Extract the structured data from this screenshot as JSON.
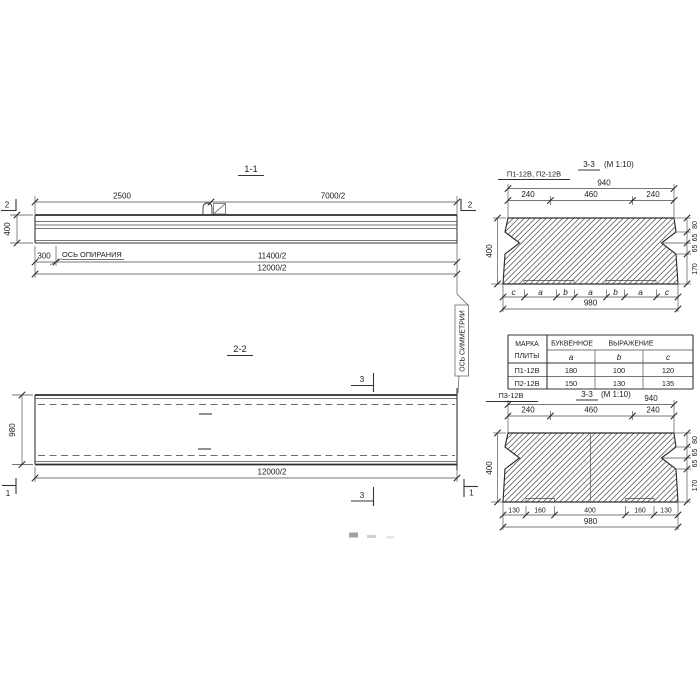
{
  "s11": {
    "title": "1-1",
    "cut_mark": "2",
    "dim_2500": "2500",
    "dim_7000": "7000/2",
    "dim_400": "400",
    "dim_300": "300",
    "support_axis_label": "ОСЬ ОПИРАНИЯ",
    "dim_11400": "11400/2",
    "dim_12000": "12000/2"
  },
  "sym": {
    "label": "ОСЬ СИММЕТРИИ"
  },
  "s22": {
    "title": "2-2",
    "dim_980": "980",
    "dim_12000": "12000/2",
    "cut_mark_3": "3",
    "cut_mark_1": "1"
  },
  "s33a": {
    "mark": "П1-12В, П2-12В",
    "title": "3-3",
    "scale": "(М 1:10)",
    "dim_940": "940",
    "dim_240": "240",
    "dim_460": "460",
    "dim_400": "400",
    "right_dims": [
      "80",
      "65",
      "65",
      "170"
    ],
    "letters": [
      "c",
      "a",
      "b",
      "a",
      "b",
      "a",
      "c"
    ],
    "dim_980": "980"
  },
  "tbl": {
    "h1a": "МАРКА",
    "h1b": "ПЛИТЫ",
    "h2a": "БУКВЕННОЕ",
    "h2b": "ВЫРАЖЕНИЕ",
    "cols": [
      "a",
      "b",
      "c"
    ],
    "rows": [
      [
        "П1-12В",
        "180",
        "100",
        "120"
      ],
      [
        "П2-12В",
        "150",
        "130",
        "135"
      ]
    ]
  },
  "s33b": {
    "mark": "П3-12В",
    "title": "3-3",
    "scale": "(М 1:10)",
    "dim_940": "940",
    "dim_240": "240",
    "dim_460": "460",
    "dim_400": "400",
    "right_dims": [
      "80",
      "65",
      "65",
      "170"
    ],
    "bottom_dims": [
      "130",
      "160",
      "400",
      "160",
      "130"
    ],
    "dim_980": "980"
  }
}
